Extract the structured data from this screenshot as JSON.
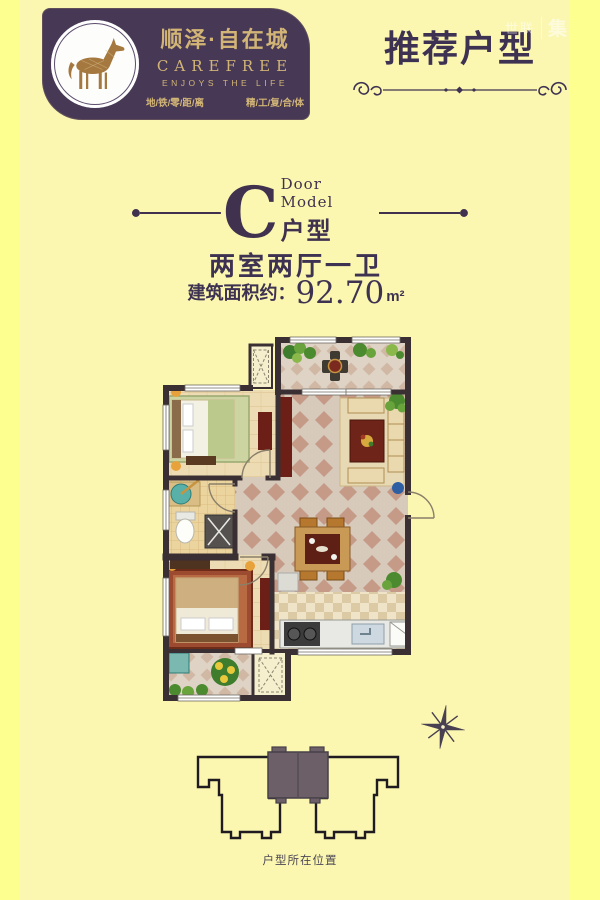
{
  "colors": {
    "background": "#fbf7b0",
    "frame": "#fdff8e",
    "brand_purple": "#473956",
    "gold": "#d2b576",
    "heading_purple": "#3e3252",
    "wall": "#3a3033",
    "accent_red": "#6e2418",
    "building_highlight": "#6c5f67"
  },
  "logo": {
    "title": "顺泽·自在城",
    "subtitle": "CAREFREE",
    "tagline": "ENJOYS THE LIFE",
    "slogan_left": "地/铁/零/距/离",
    "slogan_right": "精/工/复/合/体"
  },
  "header": {
    "title": "推荐户型",
    "watermark_left": "世联",
    "watermark_right": "集"
  },
  "model": {
    "letter": "C",
    "label_en": "Door Model",
    "label_cn": "户型"
  },
  "specs": {
    "layout": "两室两厅一卫",
    "area_label": "建筑面积约：",
    "area_value": "92.70",
    "area_unit": "m²"
  },
  "floorplan": {
    "rooms": [
      "north-balcony",
      "bedroom",
      "living-room",
      "dining-area",
      "bathroom",
      "master-bedroom",
      "kitchen",
      "south-balcony",
      "entry"
    ]
  },
  "location": {
    "caption": "户型所在位置"
  }
}
